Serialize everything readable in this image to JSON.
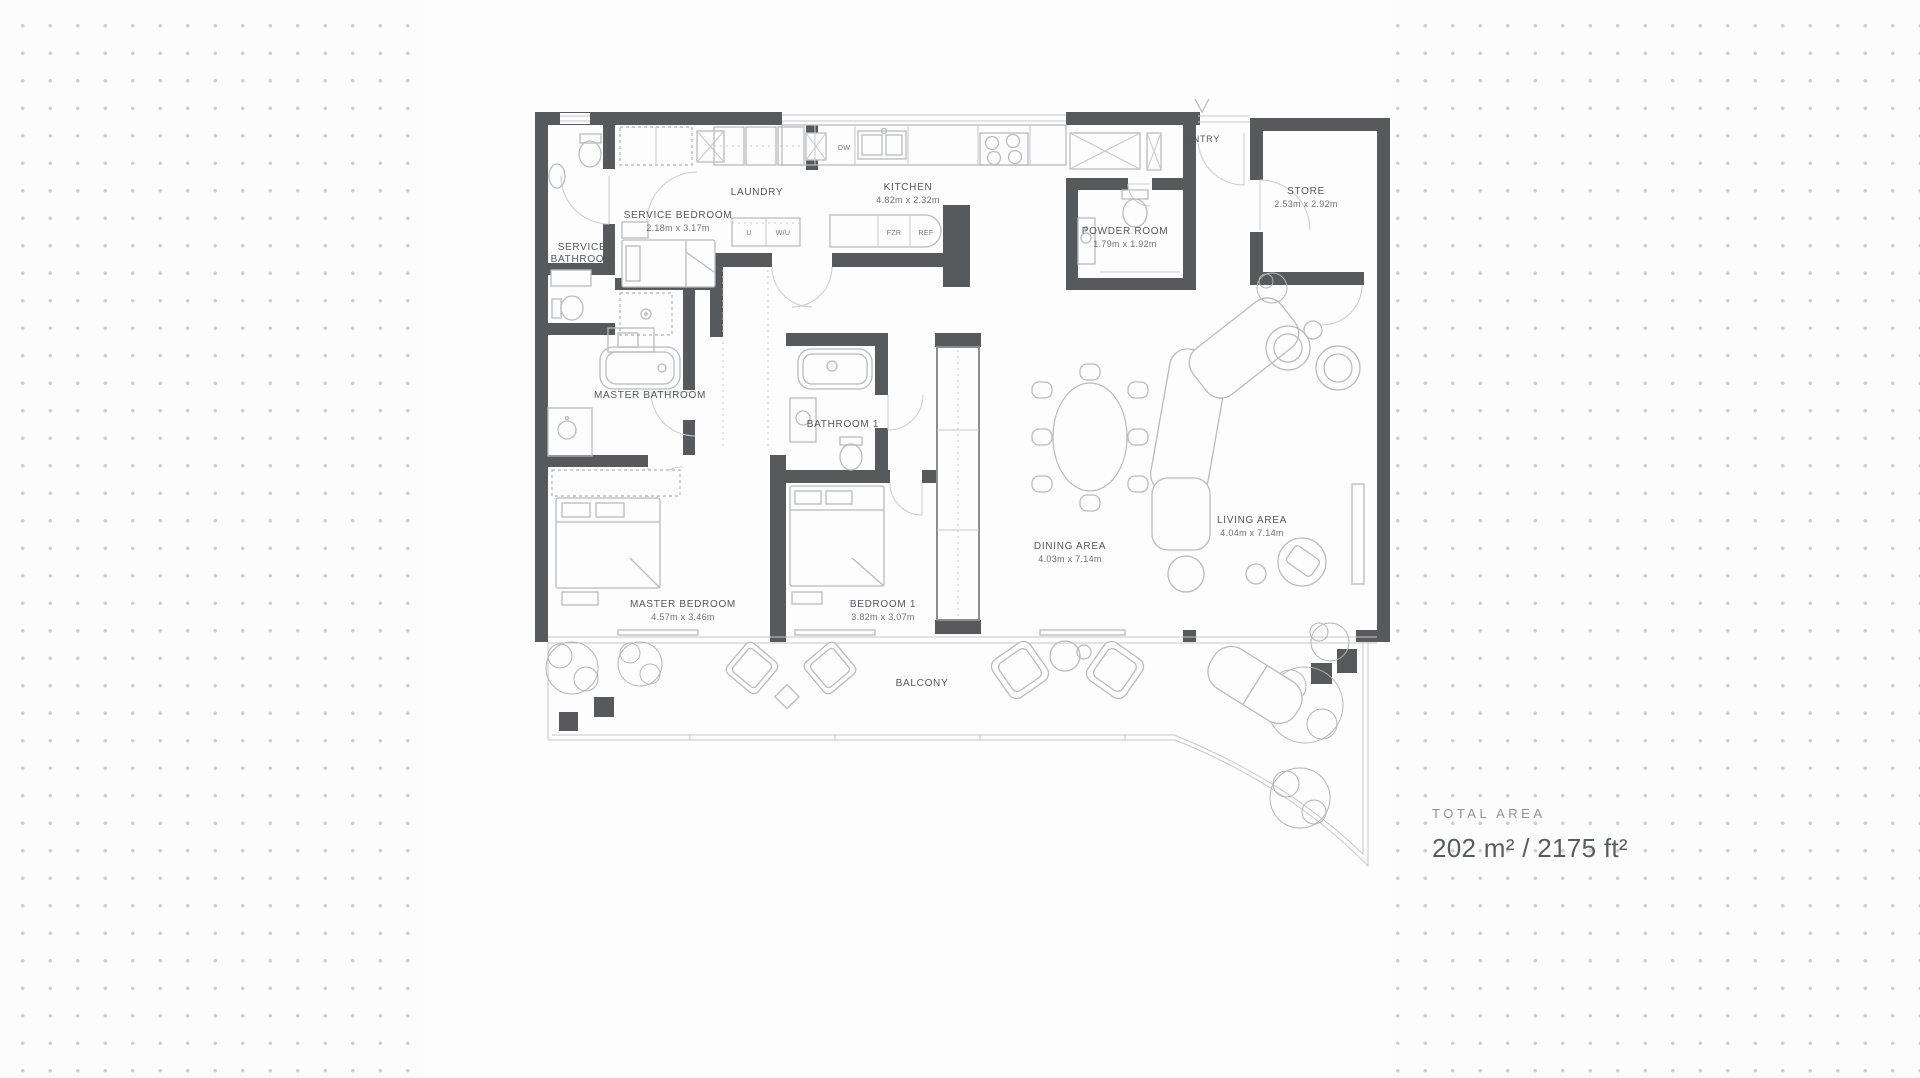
{
  "summary": {
    "title": "TOTAL AREA",
    "value": "202 m² / 2175 ft²"
  },
  "rooms": {
    "service_bathroom": {
      "name_line1": "SERVICE",
      "name_line2": "BATHROOM"
    },
    "service_bedroom": {
      "name": "SERVICE BEDROOM",
      "dims": "2.18m x 3.17m"
    },
    "laundry": {
      "name": "LAUNDRY"
    },
    "kitchen": {
      "name": "KITCHEN",
      "dims": "4.82m x 2.32m"
    },
    "powder_room": {
      "name": "POWDER ROOM",
      "dims": "1.79m x 1.92m"
    },
    "entry": {
      "name": "ENTRY"
    },
    "store": {
      "name": "STORE",
      "dims": "2.53m x 2.92m"
    },
    "master_bathroom": {
      "name": "MASTER BATHROOM"
    },
    "bathroom_1": {
      "name": "BATHROOM 1"
    },
    "master_bedroom": {
      "name": "MASTER BEDROOM",
      "dims": "4.57m x 3.46m"
    },
    "bedroom_1": {
      "name": "BEDROOM 1",
      "dims": "3.82m x 3.07m"
    },
    "dining_area": {
      "name": "DINING AREA",
      "dims": "4.03m x 7.14m"
    },
    "living_area": {
      "name": "LIVING AREA",
      "dims": "4.04m x 7.14m"
    },
    "balcony": {
      "name": "BALCONY"
    }
  },
  "appliances": {
    "dw": "DW",
    "u": "U",
    "wu": "W/U",
    "fzr": "FZR",
    "ref": "REF"
  },
  "colors": {
    "wall": "#58595b",
    "furniture_line": "#b9bbbd",
    "label_text": "#54565a",
    "dots": "#cdcdcd",
    "panel": "#fdfdfd"
  }
}
